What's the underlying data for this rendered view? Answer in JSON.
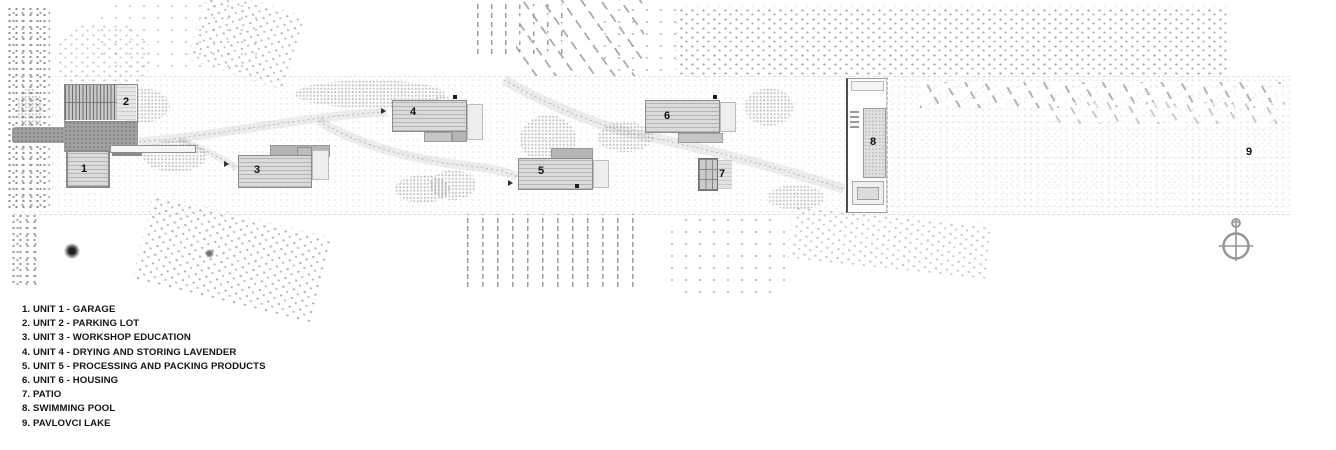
{
  "plan": {
    "unit_labels": [
      "1",
      "2",
      "3",
      "4",
      "5",
      "6",
      "7",
      "8",
      "9"
    ],
    "colors": {
      "building_fill": "#dadada",
      "building_dark": "#b5b5b5",
      "road": "#a0a0a0",
      "vegetation_dots": "#9c9c9c",
      "pool_border": "#4d4d4d",
      "label_text": "#0f0f0f"
    }
  },
  "legend": {
    "items": [
      "1. UNIT 1 - GARAGE",
      "2. UNIT 2 - PARKING LOT",
      "3. UNIT 3 - WORKSHOP EDUCATION",
      "4. UNIT 4 - DRYING AND STORING LAVENDER",
      "5. UNIT 5 - PROCESSING AND PACKING PRODUCTS",
      "6. UNIT 6 - HOUSING",
      "7. PATIO",
      "8. SWIMMING POOL",
      "9. PAVLOVCI LAKE"
    ]
  }
}
